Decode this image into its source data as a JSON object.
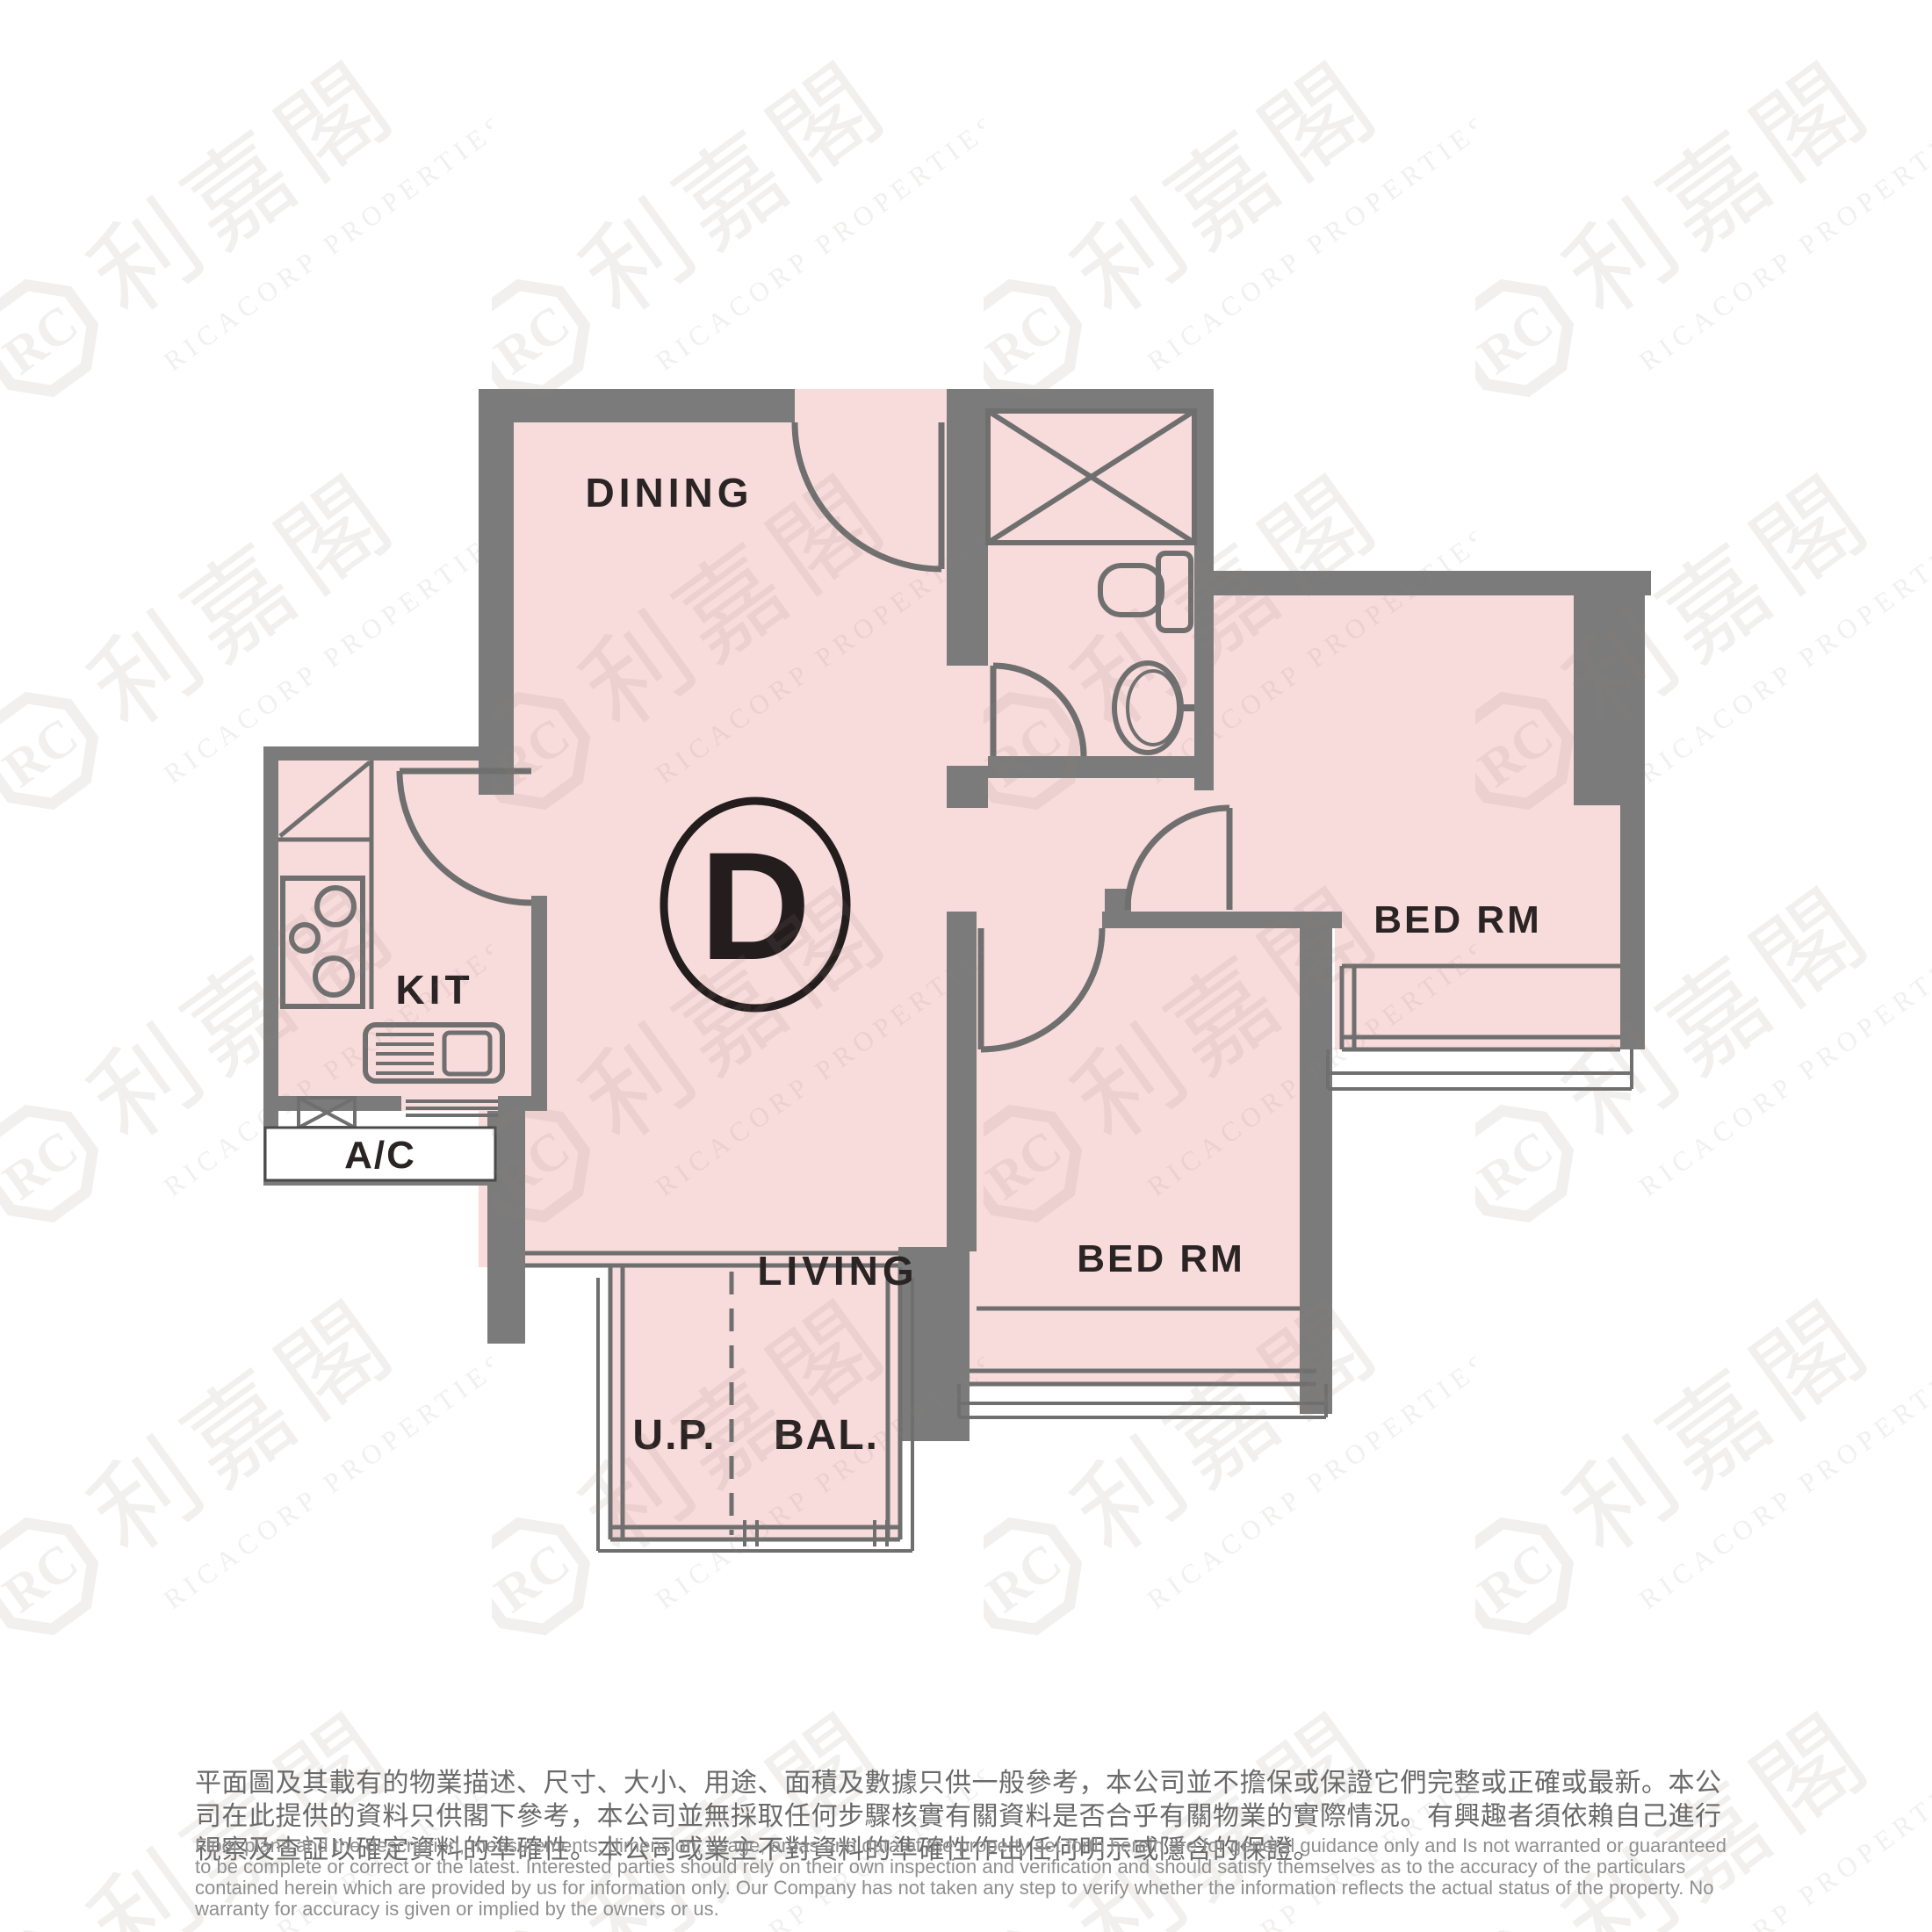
{
  "floorplan": {
    "unit_label": "D",
    "labels": {
      "dining": "DINING",
      "kitchen": "KIT",
      "living": "LIVING",
      "bedroom_top": "BED RM",
      "bedroom_bottom": "BED RM",
      "utility_platform": "U.P.",
      "balcony": "BAL.",
      "ac_platform": "A/C"
    },
    "colors": {
      "floor": "#f8dbdb",
      "wall": "#7b7b7b",
      "fixture_line": "#6f6f6f",
      "label_text": "#2b2424",
      "ac_border": "#4a4a4a"
    }
  },
  "watermark": {
    "monogram": "RC",
    "chinese": "利嘉閣",
    "english": "RICACORP PROPERTIES",
    "color": "#8a7c77"
  },
  "disclaimer": {
    "zh": "平面圖及其載有的物業描述、尺寸、大小、用途、面積及數據只供一般參考，本公司並不擔保或保證它們完整或正確或最新。本公司在此提供的資料只供閣下參考，本公司並無採取任何步驟核實有關資料是否合乎有關物業的實際情況。有興趣者須依賴自己進行視察及查証以確定資料的準確性。本公司或業主不對資料的準確性作出任何明示或隱含的保證。",
    "en": "Floor plans and the description, measurements, dimension, usage, areas and data of the property set forth herein are for general guidance only and Is not warranted or guaranteed to be complete or correct or the latest. Interested parties should rely on their own inspection and verification and should satisfy themselves as to the accuracy of the particulars contained herein which are provided by us for information only.  Our Company has not taken any step to verify whether the information reflects the actual status of the property.  No warranty for accuracy is given or implied by the owners or us."
  }
}
